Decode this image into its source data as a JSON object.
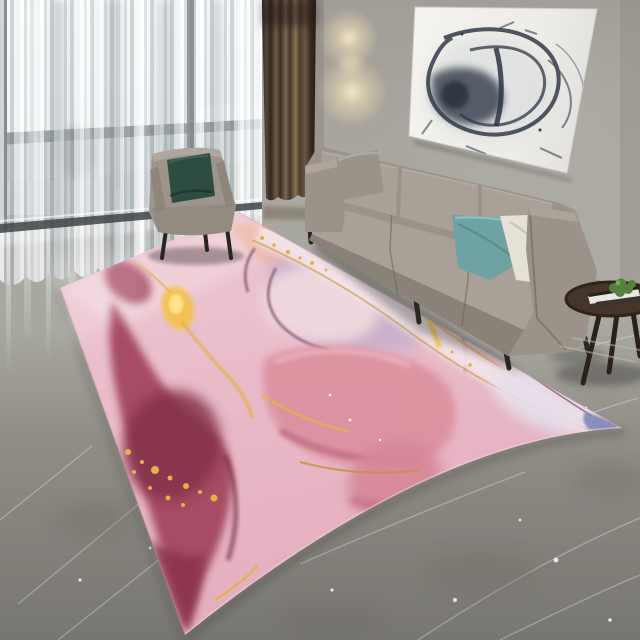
{
  "meta": {
    "title": "Living room product photo — pink and gold abstract marble area rug",
    "image_type": "photograph",
    "room": "living room"
  },
  "scene": {
    "window": "floor-to-ceiling window with white sheer curtains, balcony railing visible behind",
    "drape": "dark brown blackout curtain panel beside window",
    "wall": "warm gray wall lit by an unseen sconce (two warm glow pools)",
    "wall_art": "large white canvas with abstract black-navy ink scribble, hung tilted in perspective",
    "sofa": "gray fabric three-seat sofa angled from back-left to front-right",
    "sofa_pillows": [
      "gray pillow on left arm",
      "teal pillow",
      "ivory pillow"
    ],
    "armchair": "gray armchair with dark green pillow standing on rug corner in front of window",
    "side_table": "round dark wood side table with books and small green plant",
    "floor": "glossy gray marble tile with light veins and curtain reflections",
    "rug": "large pink alcohol-ink marble rug with burgundy flows, lavender washes, gold veins and speckles, small blue tip at right corner"
  },
  "colors": {
    "wall": "#a7a39d",
    "wall_shadow": "#8f8b85",
    "floor_far": "#a5a49d",
    "floor_near": "#7b7972",
    "sheer": "#dfe5e8",
    "window_frame": "#4b5156",
    "railing": "#5d656b",
    "curtain_brown": "#5b4936",
    "sconce_glow": "#f0e2bf",
    "canvas": "#f0efeb",
    "ink": "#323a48",
    "sofa": "#9b9389",
    "sofa_dark": "#8a8278",
    "sofa_cushion": "#a9a197",
    "pillow_gray": "#99938a",
    "pillow_teal": "#6fa2a3",
    "pillow_ivory": "#e5e1d7",
    "armchair": "#9d958b",
    "armchair_pillow": "#2e4d41",
    "table_wood": "#44362a",
    "plant": "#55813f",
    "book_white": "#e9e7e1",
    "rug_pink": "#e9bcc9",
    "rug_pink_light": "#f0d8de",
    "rug_lavender": "#c7b0ca",
    "rug_rose": "#dc92a0",
    "rug_burgundy": "#a3475f",
    "rug_wine_dark": "#84304a",
    "rug_gold": "#e3b04b",
    "rug_gold_bright": "#f7cf62",
    "rug_cream": "#f3e4e9",
    "rug_blue": "#7e88b8",
    "rug_plum_vein": "#7b4c63",
    "leg_dark": "#3a332c",
    "shadow": "#33302c"
  }
}
